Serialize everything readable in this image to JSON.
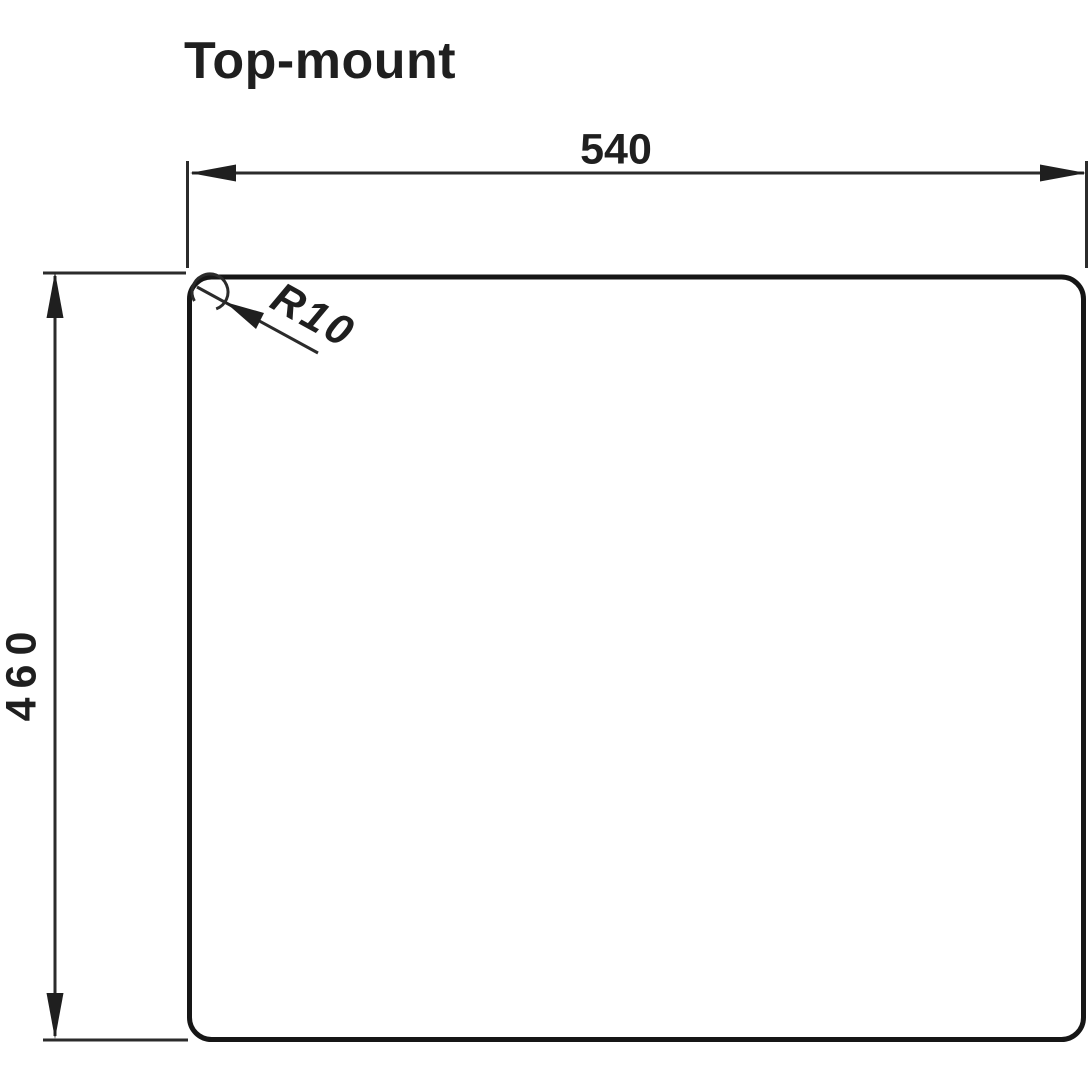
{
  "title": "Top-mount",
  "dimensions": {
    "width": {
      "label": "540"
    },
    "height": {
      "label": "460"
    },
    "corner_radius": {
      "label": "R10"
    }
  },
  "colors": {
    "ink": "#1f1f1f",
    "line": "#2b2b2b",
    "background": "#ffffff"
  }
}
